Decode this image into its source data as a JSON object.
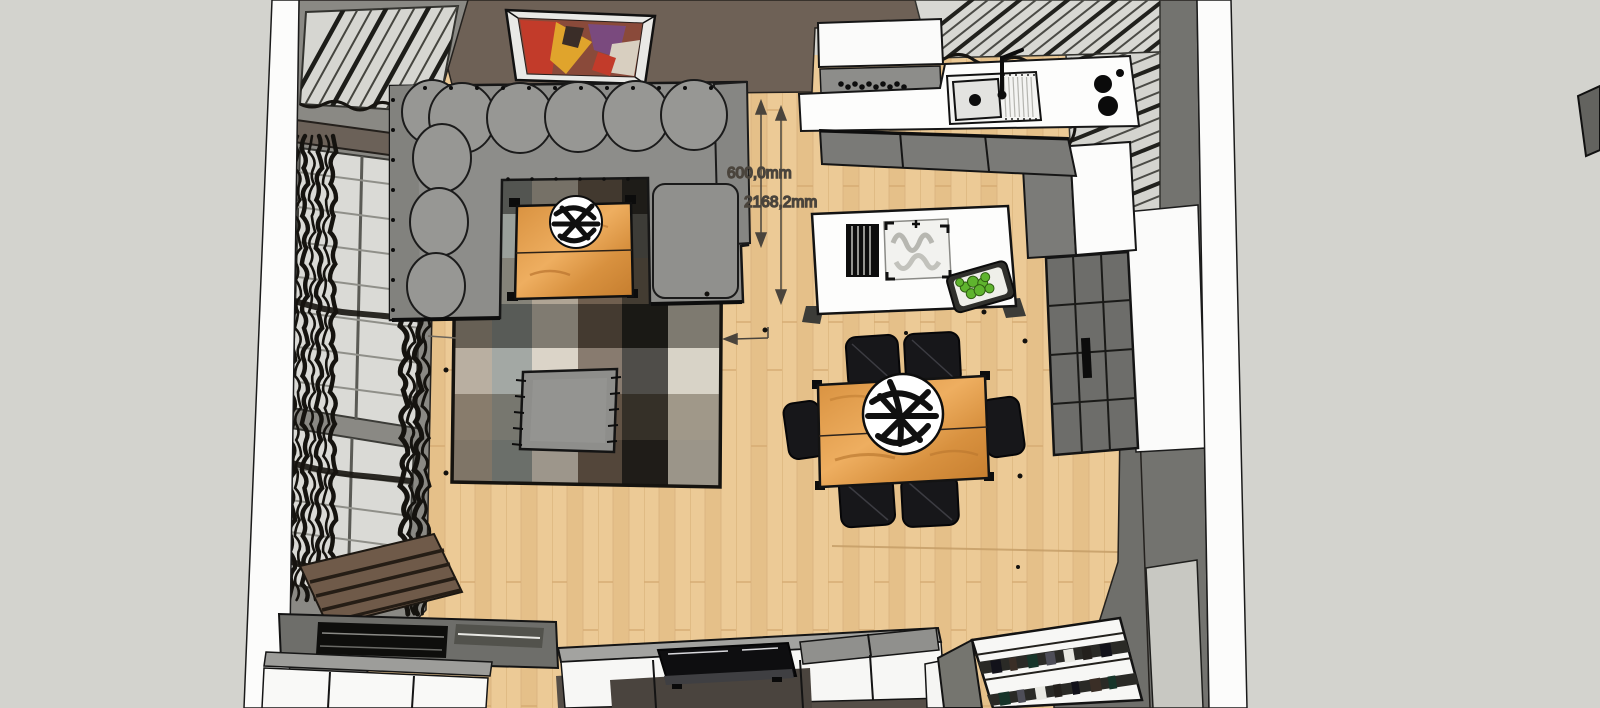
{
  "scene": {
    "type": "3d-floor-plan-top-view",
    "description": "Overhead SketchUp-style rendering of an open-plan living room and kitchen"
  },
  "annotations": {
    "dim_vertical_small": "600,0mm",
    "dim_vertical_large": "2168,2mm"
  },
  "palette": {
    "background": "#d3d3ce",
    "wall_band_white": "#fcfcfb",
    "wall_taupe": "#6e6156",
    "wall_gray_left": "#8a8984",
    "wall_gray_right": "#73736f",
    "floor_wood": "#ecca96",
    "sofa_gray": "#8d8d8a",
    "wood_furniture": "#d78f42",
    "chair_black": "#17171a",
    "fruit_green": "#5fb42e",
    "annotation_text": "#3e3933"
  },
  "objects": [
    "corner-sofa",
    "coffee-table",
    "decor-bowl",
    "plaid-rug",
    "ottoman",
    "dining-table",
    "dining-chairs",
    "kitchen-island",
    "dish-rack",
    "cooktop",
    "fruit-tray",
    "kitchen-counter",
    "sink",
    "upper-cabinet",
    "base-cabinets",
    "fridge-cabinet",
    "grid-cabinet",
    "wall-art",
    "window-blinds",
    "curtains",
    "tv-console",
    "tv",
    "desk-unit",
    "bookshelf",
    "door-inset"
  ]
}
